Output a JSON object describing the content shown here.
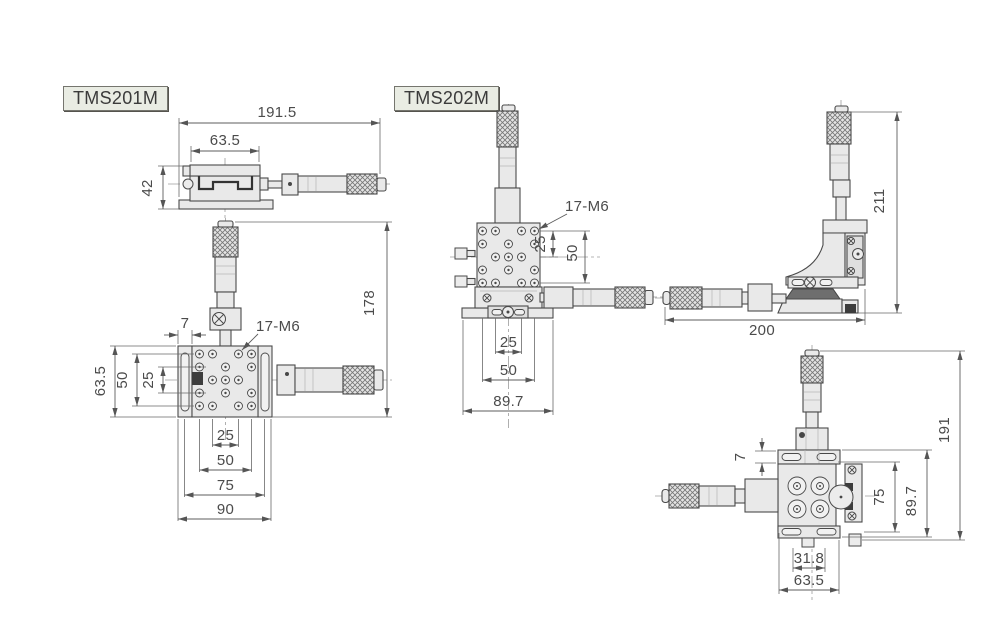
{
  "tms201m": {
    "label": "TMS201M",
    "side": {
      "w_total": "191.5",
      "w_body": "63.5",
      "h": "42"
    },
    "top": {
      "plate": "7",
      "holes": "17-M6",
      "h_total": "178",
      "h_body": "63.5",
      "h50": "50",
      "h25": "25",
      "b25": "25",
      "b50": "50",
      "b75": "75",
      "b90": "90"
    }
  },
  "tms202m": {
    "label": "TMS202M",
    "front": {
      "holes": "17-M6",
      "r25": "25",
      "r50": "50",
      "b25": "25",
      "b50": "50",
      "b89": "89.7"
    },
    "side": {
      "h": "211",
      "w": "200"
    },
    "bottom": {
      "plate": "7",
      "r75": "75",
      "r89": "89.7",
      "h": "191",
      "b31": "31.8",
      "b63": "63.5"
    }
  }
}
